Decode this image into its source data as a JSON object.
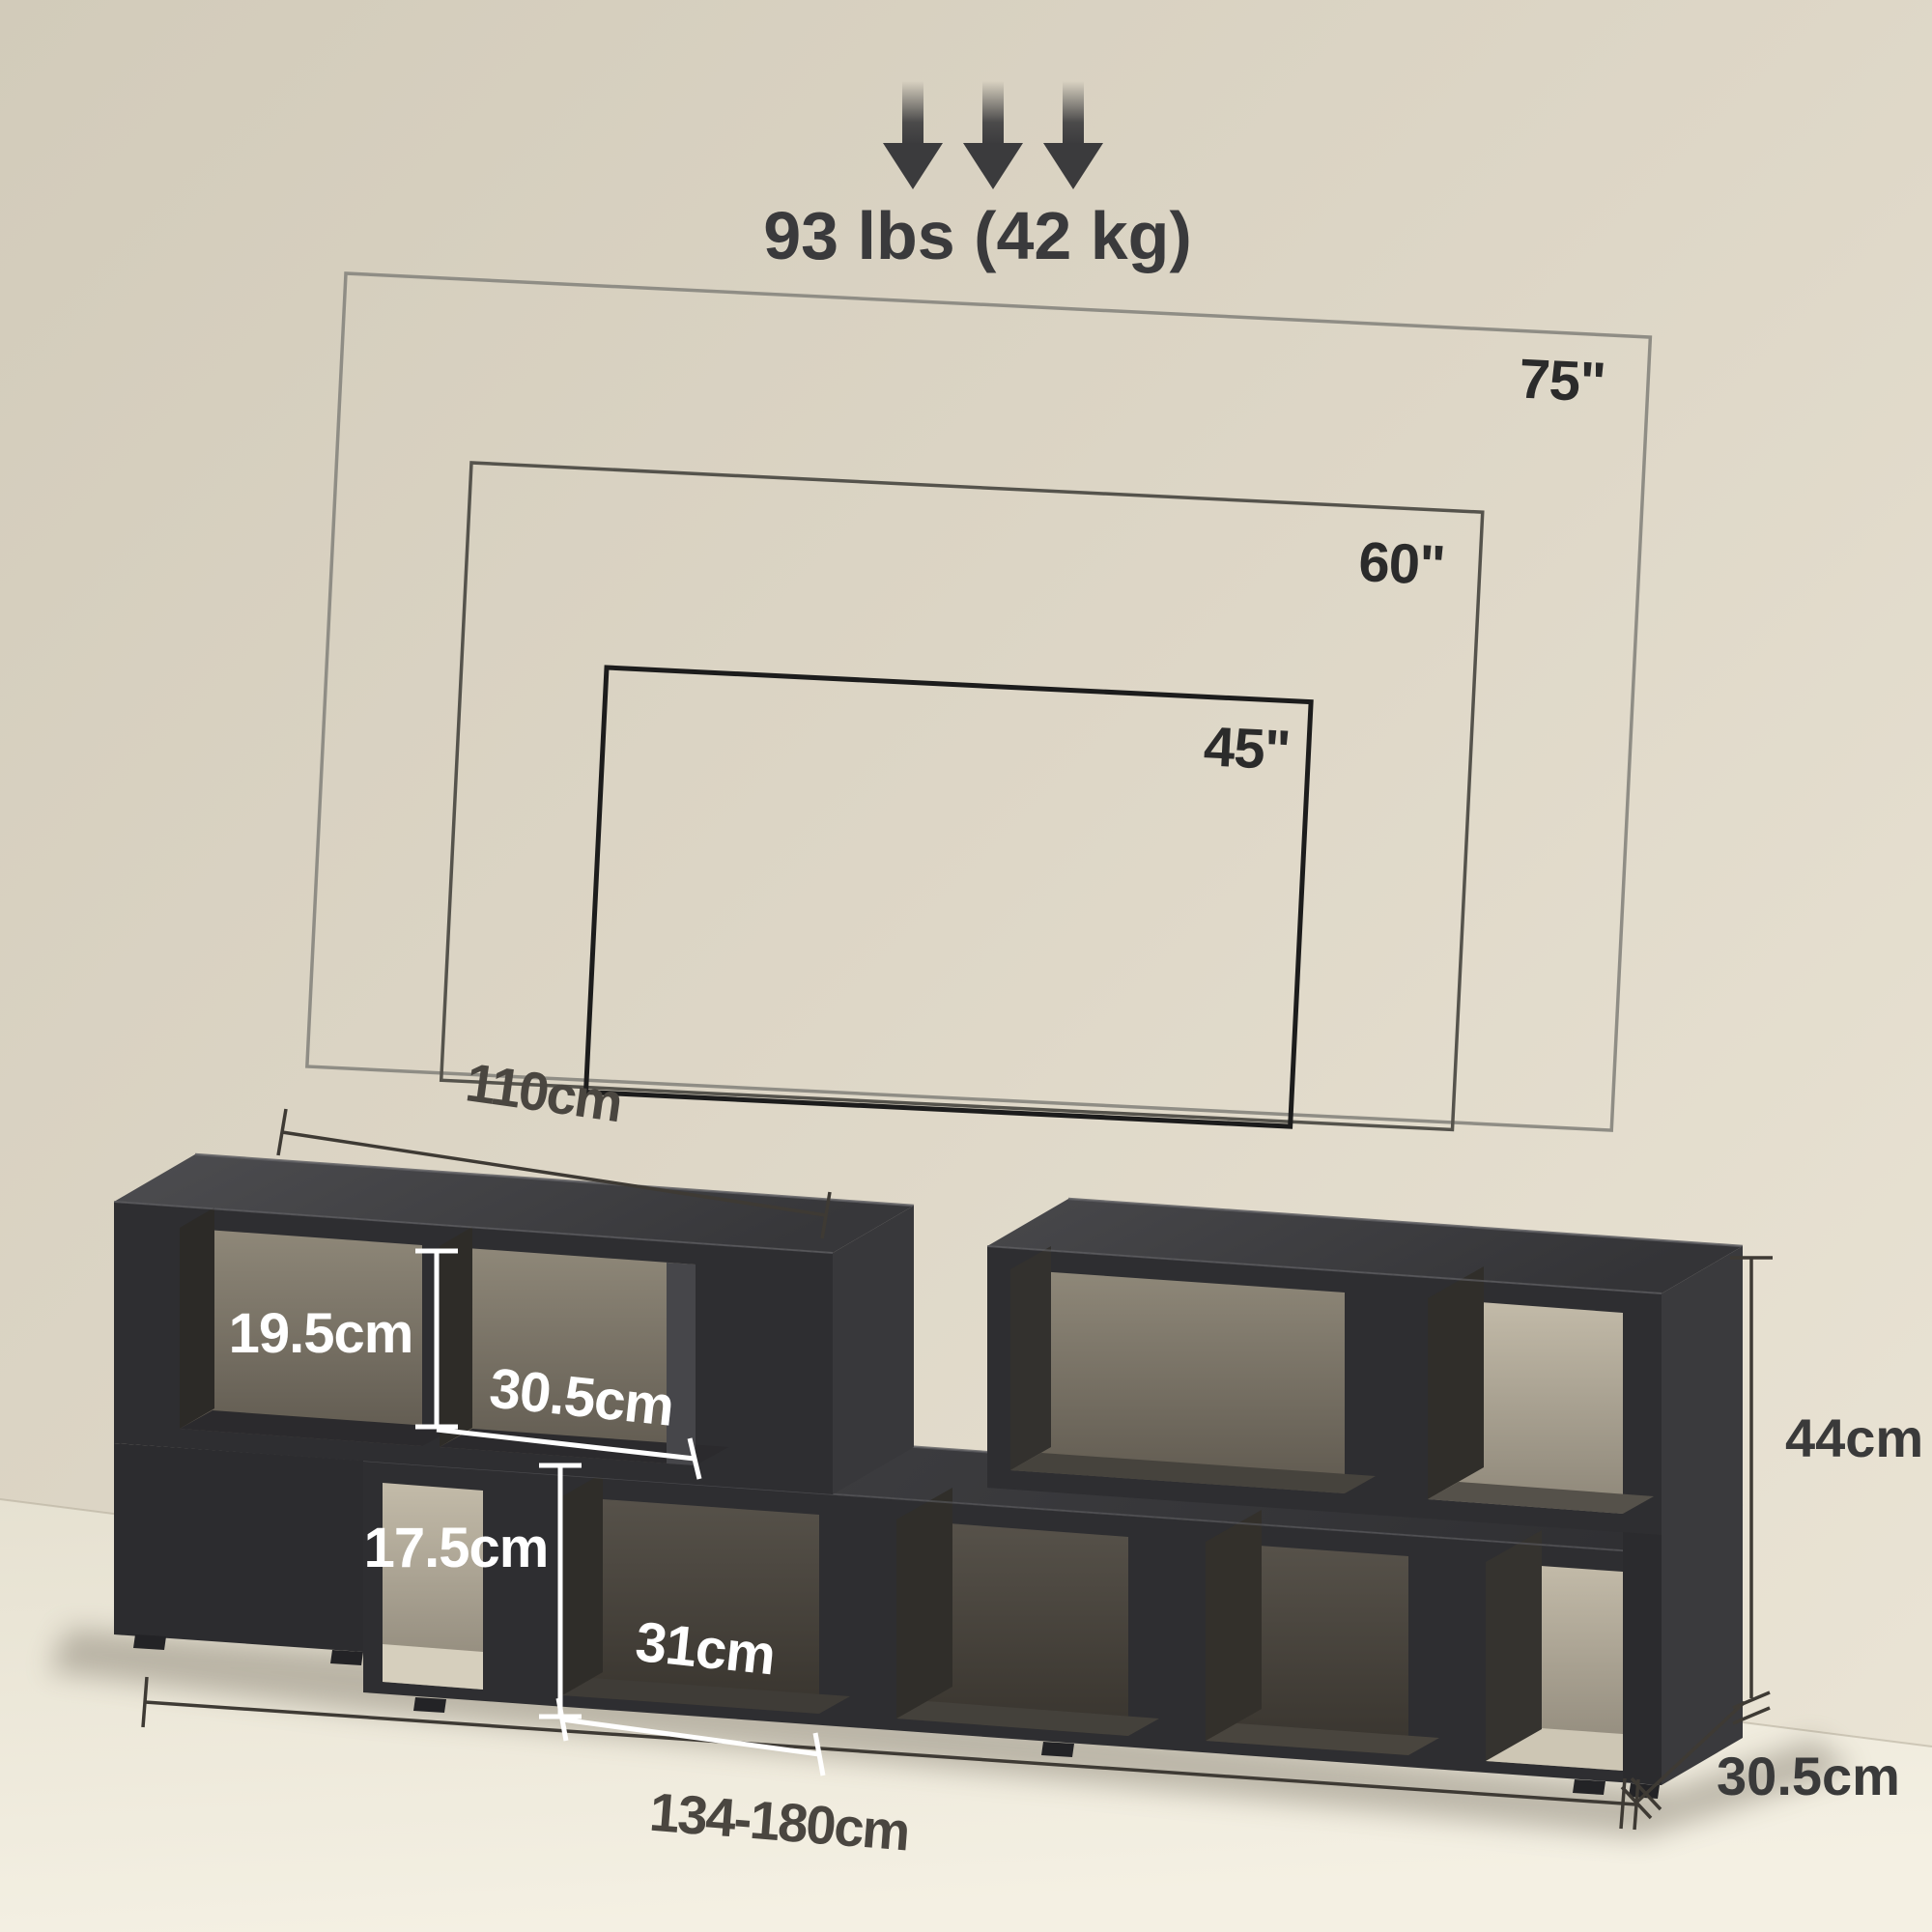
{
  "product_diagram": {
    "weight_capacity": "93 lbs (42 kg)",
    "tv_sizes": {
      "large": "75\"",
      "medium": "60\"",
      "small": "45\""
    },
    "dimensions": {
      "shelf_width": "110cm",
      "upper_opening_height": "19.5cm",
      "upper_opening_depth": "30.5cm",
      "lower_opening_height": "17.5cm",
      "lower_opening_width": "31cm",
      "overall_width_range": "134-180cm",
      "overall_height": "44cm",
      "overall_depth": "30.5cm"
    },
    "colors": {
      "wall": "#d9d2c2",
      "floor": "#efebdd",
      "stand_front": "#2e2e31",
      "stand_top": "#47474a",
      "tv_outline_75": "#8f8d85",
      "tv_outline_60": "#55534c",
      "tv_outline_45": "#1c1c1c",
      "dimension_dark": "#3e3a34",
      "dimension_white": "#ffffff"
    }
  }
}
